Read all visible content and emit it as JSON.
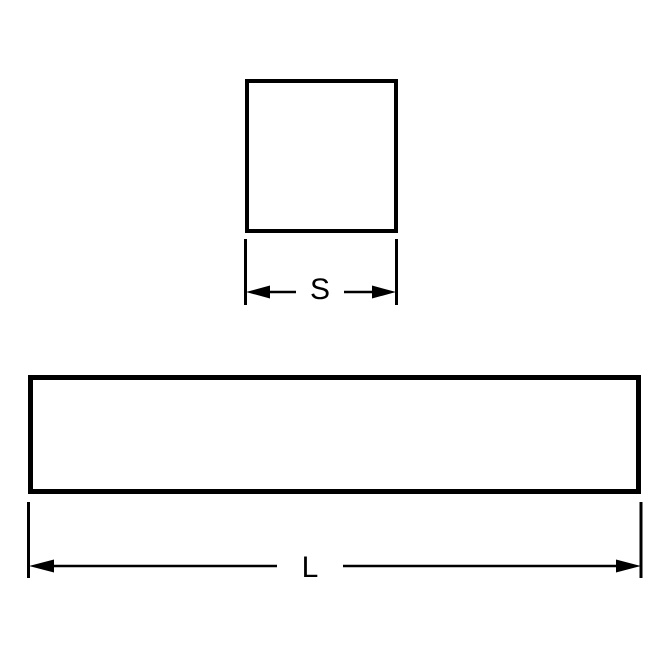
{
  "diagram": {
    "square_view": {
      "shape": "square-cross-section",
      "dimension_label": "S"
    },
    "bar_view": {
      "shape": "rectangular-bar-length",
      "dimension_label": "L"
    },
    "colors": {
      "stroke": "#000000",
      "background": "#ffffff"
    }
  }
}
